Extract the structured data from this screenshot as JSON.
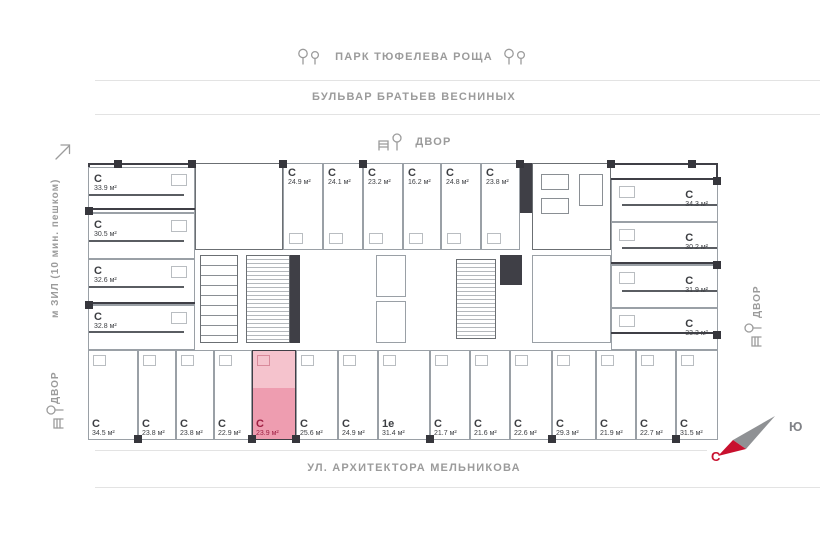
{
  "surroundings": {
    "park": "ПАРК ТЮФЕЛЕВА РОЩА",
    "boulevard": "БУЛЬВАР БРАТЬЕВ ВЕСНИНЫХ",
    "yard_top": "ДВОР",
    "yard_left": "ДВОР",
    "yard_right": "ДВОР",
    "street_bottom": "УЛ. АРХИТЕКТОРА МЕЛЬНИКОВА",
    "metro": "м ЗИЛ (10 мин. пешком)"
  },
  "compass": {
    "north": "С",
    "south": "Ю",
    "north_color": "#c8102e",
    "south_color": "#808287"
  },
  "highlight": {
    "fill_light": "#f5c3cd",
    "fill_strong": "#ee9db0",
    "label_color": "#9e2043"
  },
  "apartments": {
    "left_column": [
      {
        "type": "С",
        "area": "33.9 м²"
      },
      {
        "type": "С",
        "area": "30.5 м²"
      },
      {
        "type": "С",
        "area": "32.6 м²"
      },
      {
        "type": "С",
        "area": "32.8 м²"
      }
    ],
    "top_row": [
      {
        "type": "С",
        "area": "24.9 м²"
      },
      {
        "type": "С",
        "area": "24.1 м²"
      },
      {
        "type": "С",
        "area": "23.2 м²"
      },
      {
        "type": "С",
        "area": "16.2 м²"
      },
      {
        "type": "С",
        "area": "24.8 м²"
      },
      {
        "type": "С",
        "area": "23.8 м²"
      }
    ],
    "right_column": [
      {
        "type": "С",
        "area": "34.3 м²"
      },
      {
        "type": "С",
        "area": "30.2 м²"
      },
      {
        "type": "С",
        "area": "31.9 м²"
      },
      {
        "type": "С",
        "area": "33.3 м²"
      }
    ],
    "bottom_row": [
      {
        "type": "С",
        "area": "34.5 м²"
      },
      {
        "type": "С",
        "area": "23.8 м²"
      },
      {
        "type": "С",
        "area": "23.8 м²"
      },
      {
        "type": "С",
        "area": "22.9 м²"
      },
      {
        "type": "С",
        "area": "23.9 м²",
        "highlighted": true
      },
      {
        "type": "С",
        "area": "25.6 м²"
      },
      {
        "type": "С",
        "area": "24.9 м²"
      },
      {
        "type": "1е",
        "area": "31.4 м²"
      },
      {
        "type": "С",
        "area": "21.7 м²"
      },
      {
        "type": "С",
        "area": "21.6 м²"
      },
      {
        "type": "С",
        "area": "22.6 м²"
      },
      {
        "type": "С",
        "area": "29.3 м²"
      },
      {
        "type": "С",
        "area": "21.9 м²"
      },
      {
        "type": "С",
        "area": "22.7 м²"
      },
      {
        "type": "С",
        "area": "31.5 м²"
      }
    ]
  }
}
